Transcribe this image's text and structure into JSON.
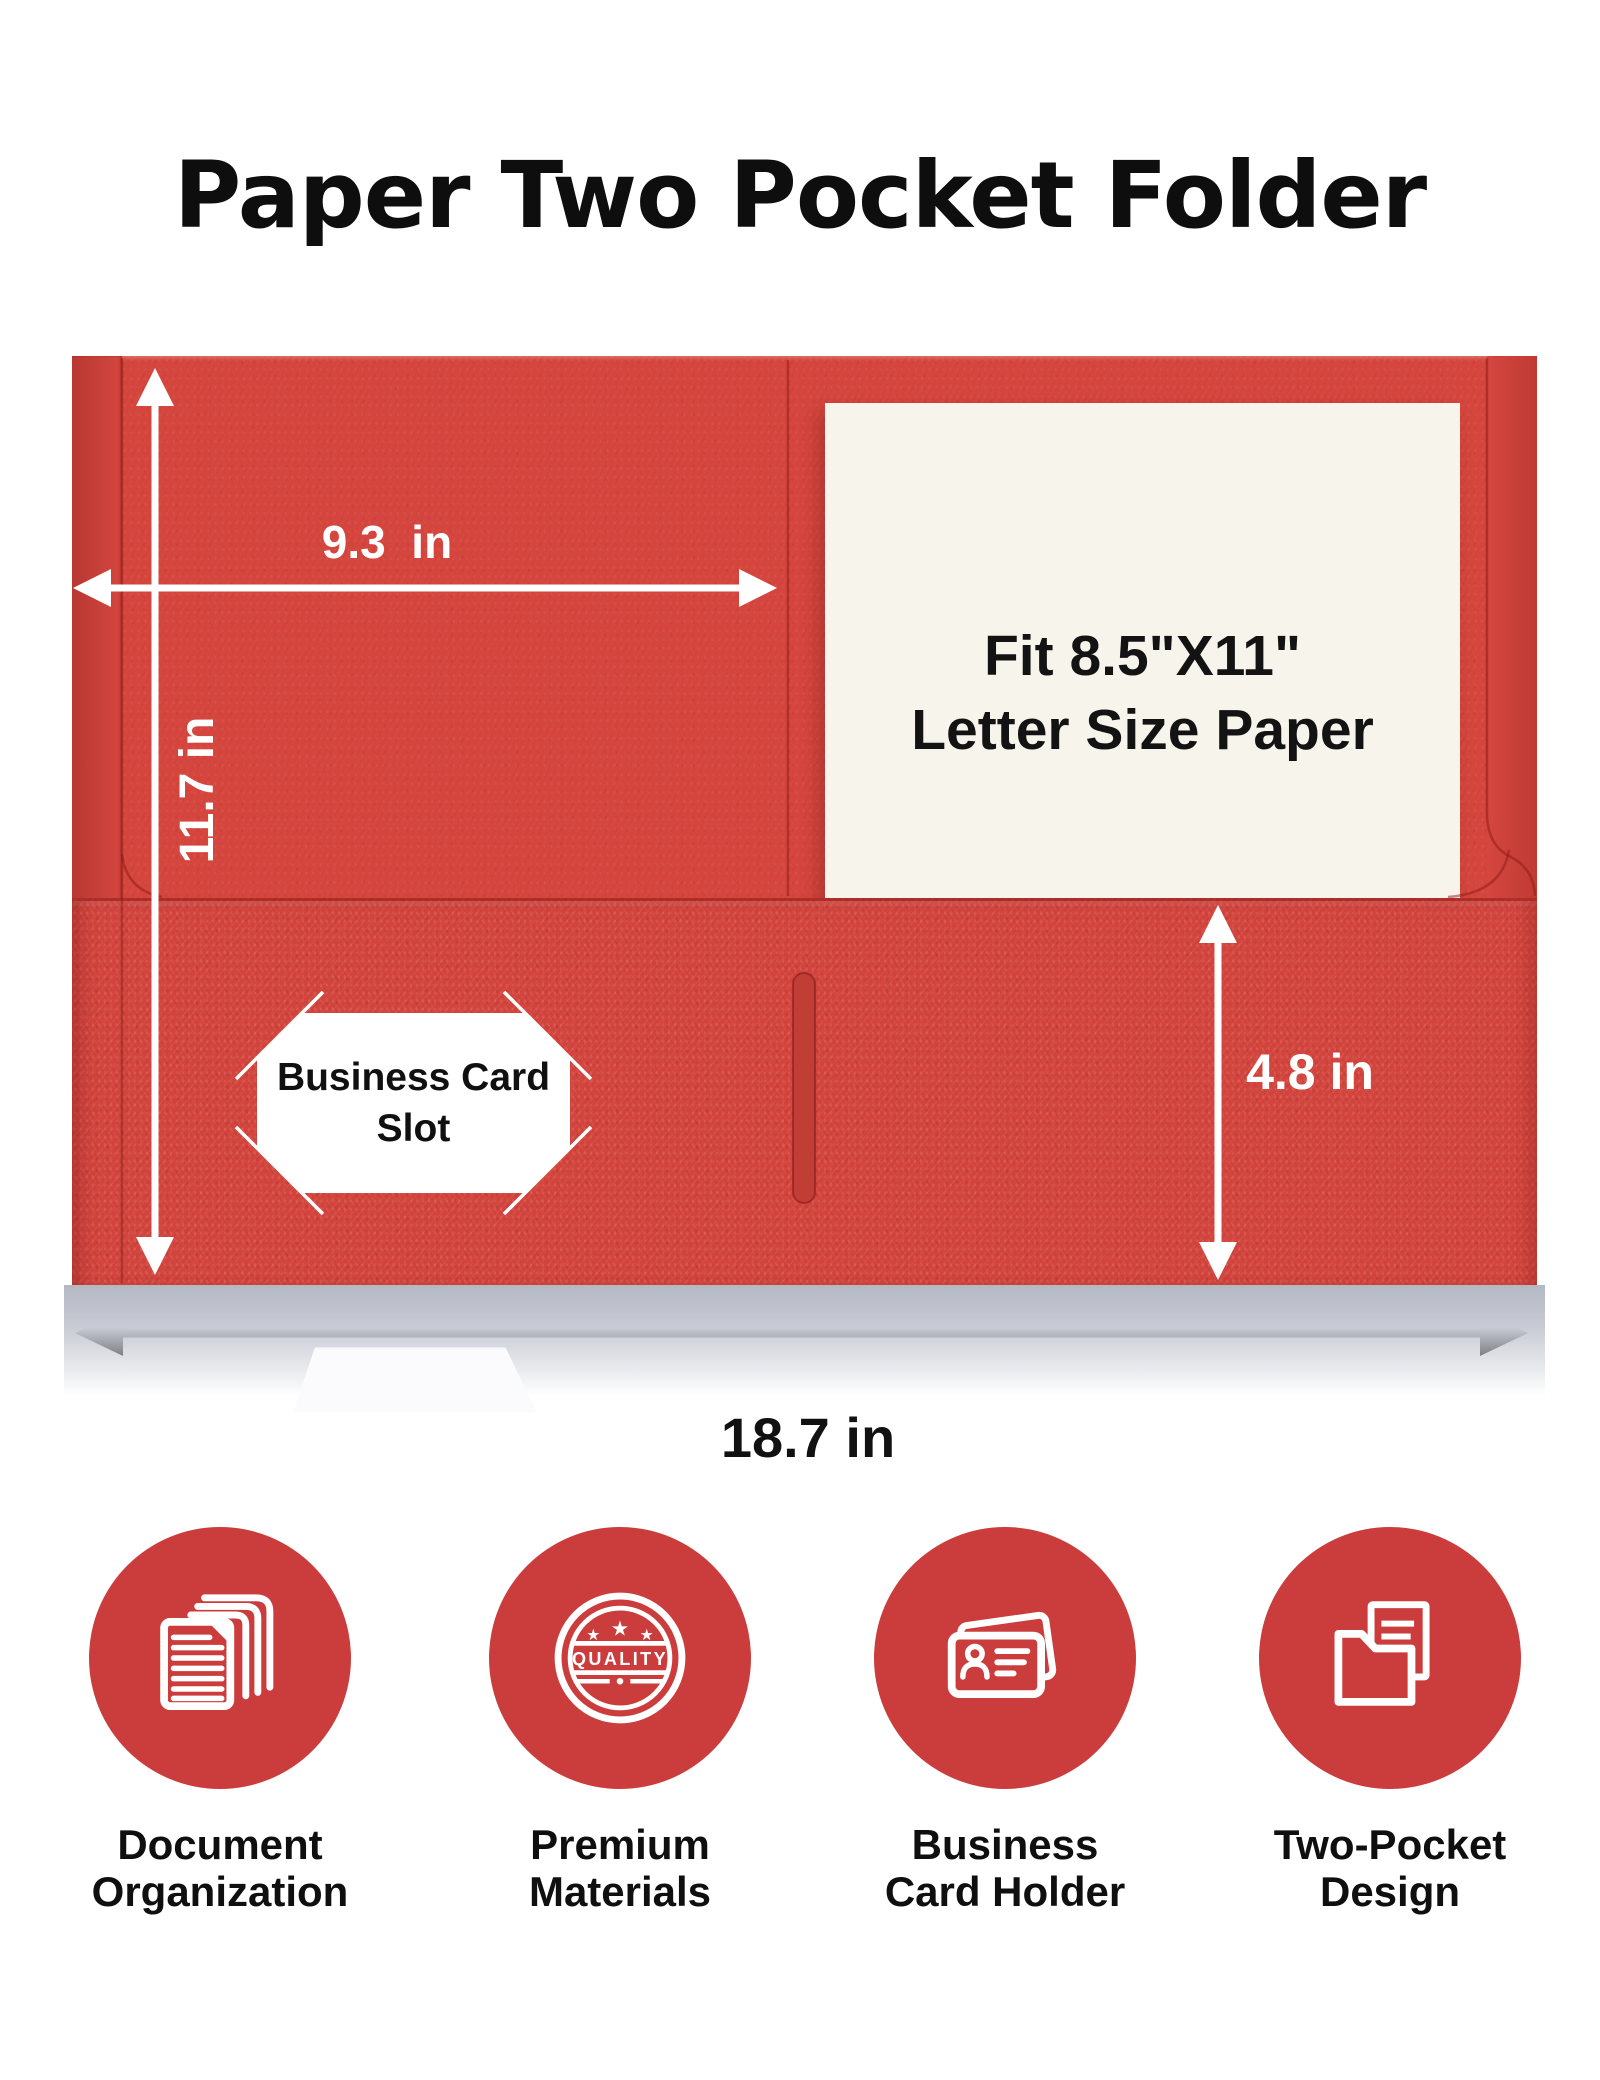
{
  "title": "Paper Two Pocket Folder",
  "folder": {
    "paper_insert": {
      "line1": "Fit 8.5\"X11\"",
      "line2": "Letter Size Paper"
    },
    "card_slot": {
      "line1": "Business Card",
      "line2": "Slot"
    },
    "dims": {
      "panel_width": "9.3  in",
      "folder_height": "11.7 in",
      "pocket_height": "4.8 in",
      "total_width": "18.7 in"
    }
  },
  "features": [
    {
      "icon": "stacked-documents-icon",
      "lines": [
        "Document",
        "Organization"
      ]
    },
    {
      "icon": "quality-badge-icon",
      "badge_text": "QUALITY",
      "lines": [
        "Premium",
        "Materials"
      ]
    },
    {
      "icon": "business-card-icon",
      "lines": [
        "Business",
        "Card Holder"
      ]
    },
    {
      "icon": "two-pocket-folder-icon",
      "lines": [
        "Two-Pocket",
        "Design"
      ]
    }
  ],
  "colors": {
    "folder_red": "#d5463e",
    "folder_edge_red": "#c23a34",
    "pocket_red": "#d4453e",
    "slit_red": "#c13e37",
    "icon_red": "#cb3d3c",
    "paper_white": "#f7f4ec",
    "arrow_white": "#ffffff",
    "arrow_black": "#111111",
    "shadow_gray": "#b6bac4",
    "title_black": "#0e0e0e"
  }
}
